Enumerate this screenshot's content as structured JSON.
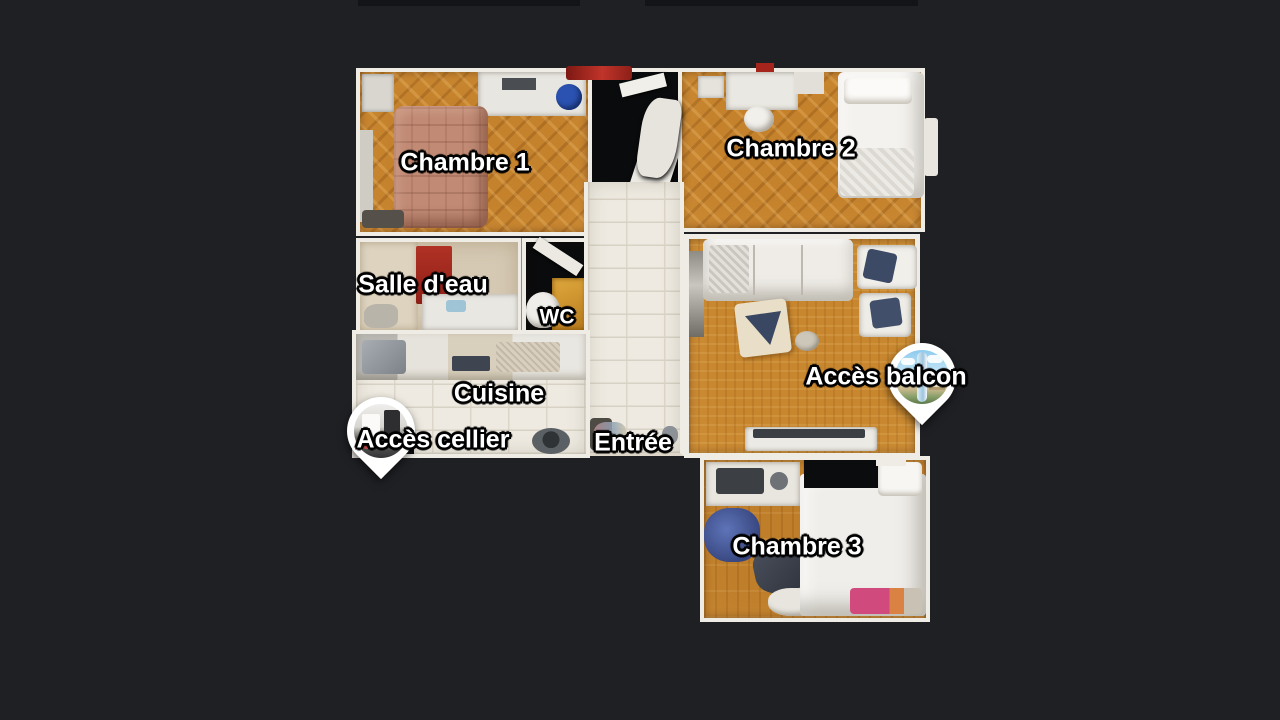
{
  "viewer": {
    "background_color": "#1f2024",
    "scene": "apartment-floorplan-top-view"
  },
  "labels": {
    "chambre1": "Chambre 1",
    "chambre2": "Chambre 2",
    "salle_deau": "Salle d'eau",
    "wc": "WC",
    "cuisine": "Cuisine",
    "entree": "Entrée",
    "chambre3": "Chambre 3"
  },
  "pins": [
    {
      "id": "acces_cellier",
      "label": "Accès cellier",
      "photo": "cellar-interior-photo"
    },
    {
      "id": "acces_balcon",
      "label": "Accès balcon",
      "photo": "balcony-sky-photo"
    }
  ],
  "colors": {
    "background": "#1f2024",
    "wall": "#efece6",
    "wood_floor": "#c5822c",
    "mosaic_floor": "#c8872e",
    "tile_floor": "#eeeae1",
    "label_text": "#ffffff",
    "label_outline": "#000000",
    "pin_body": "#ffffff",
    "red_mat": "#a52a20",
    "balcony_sky": "#8ecbee"
  }
}
